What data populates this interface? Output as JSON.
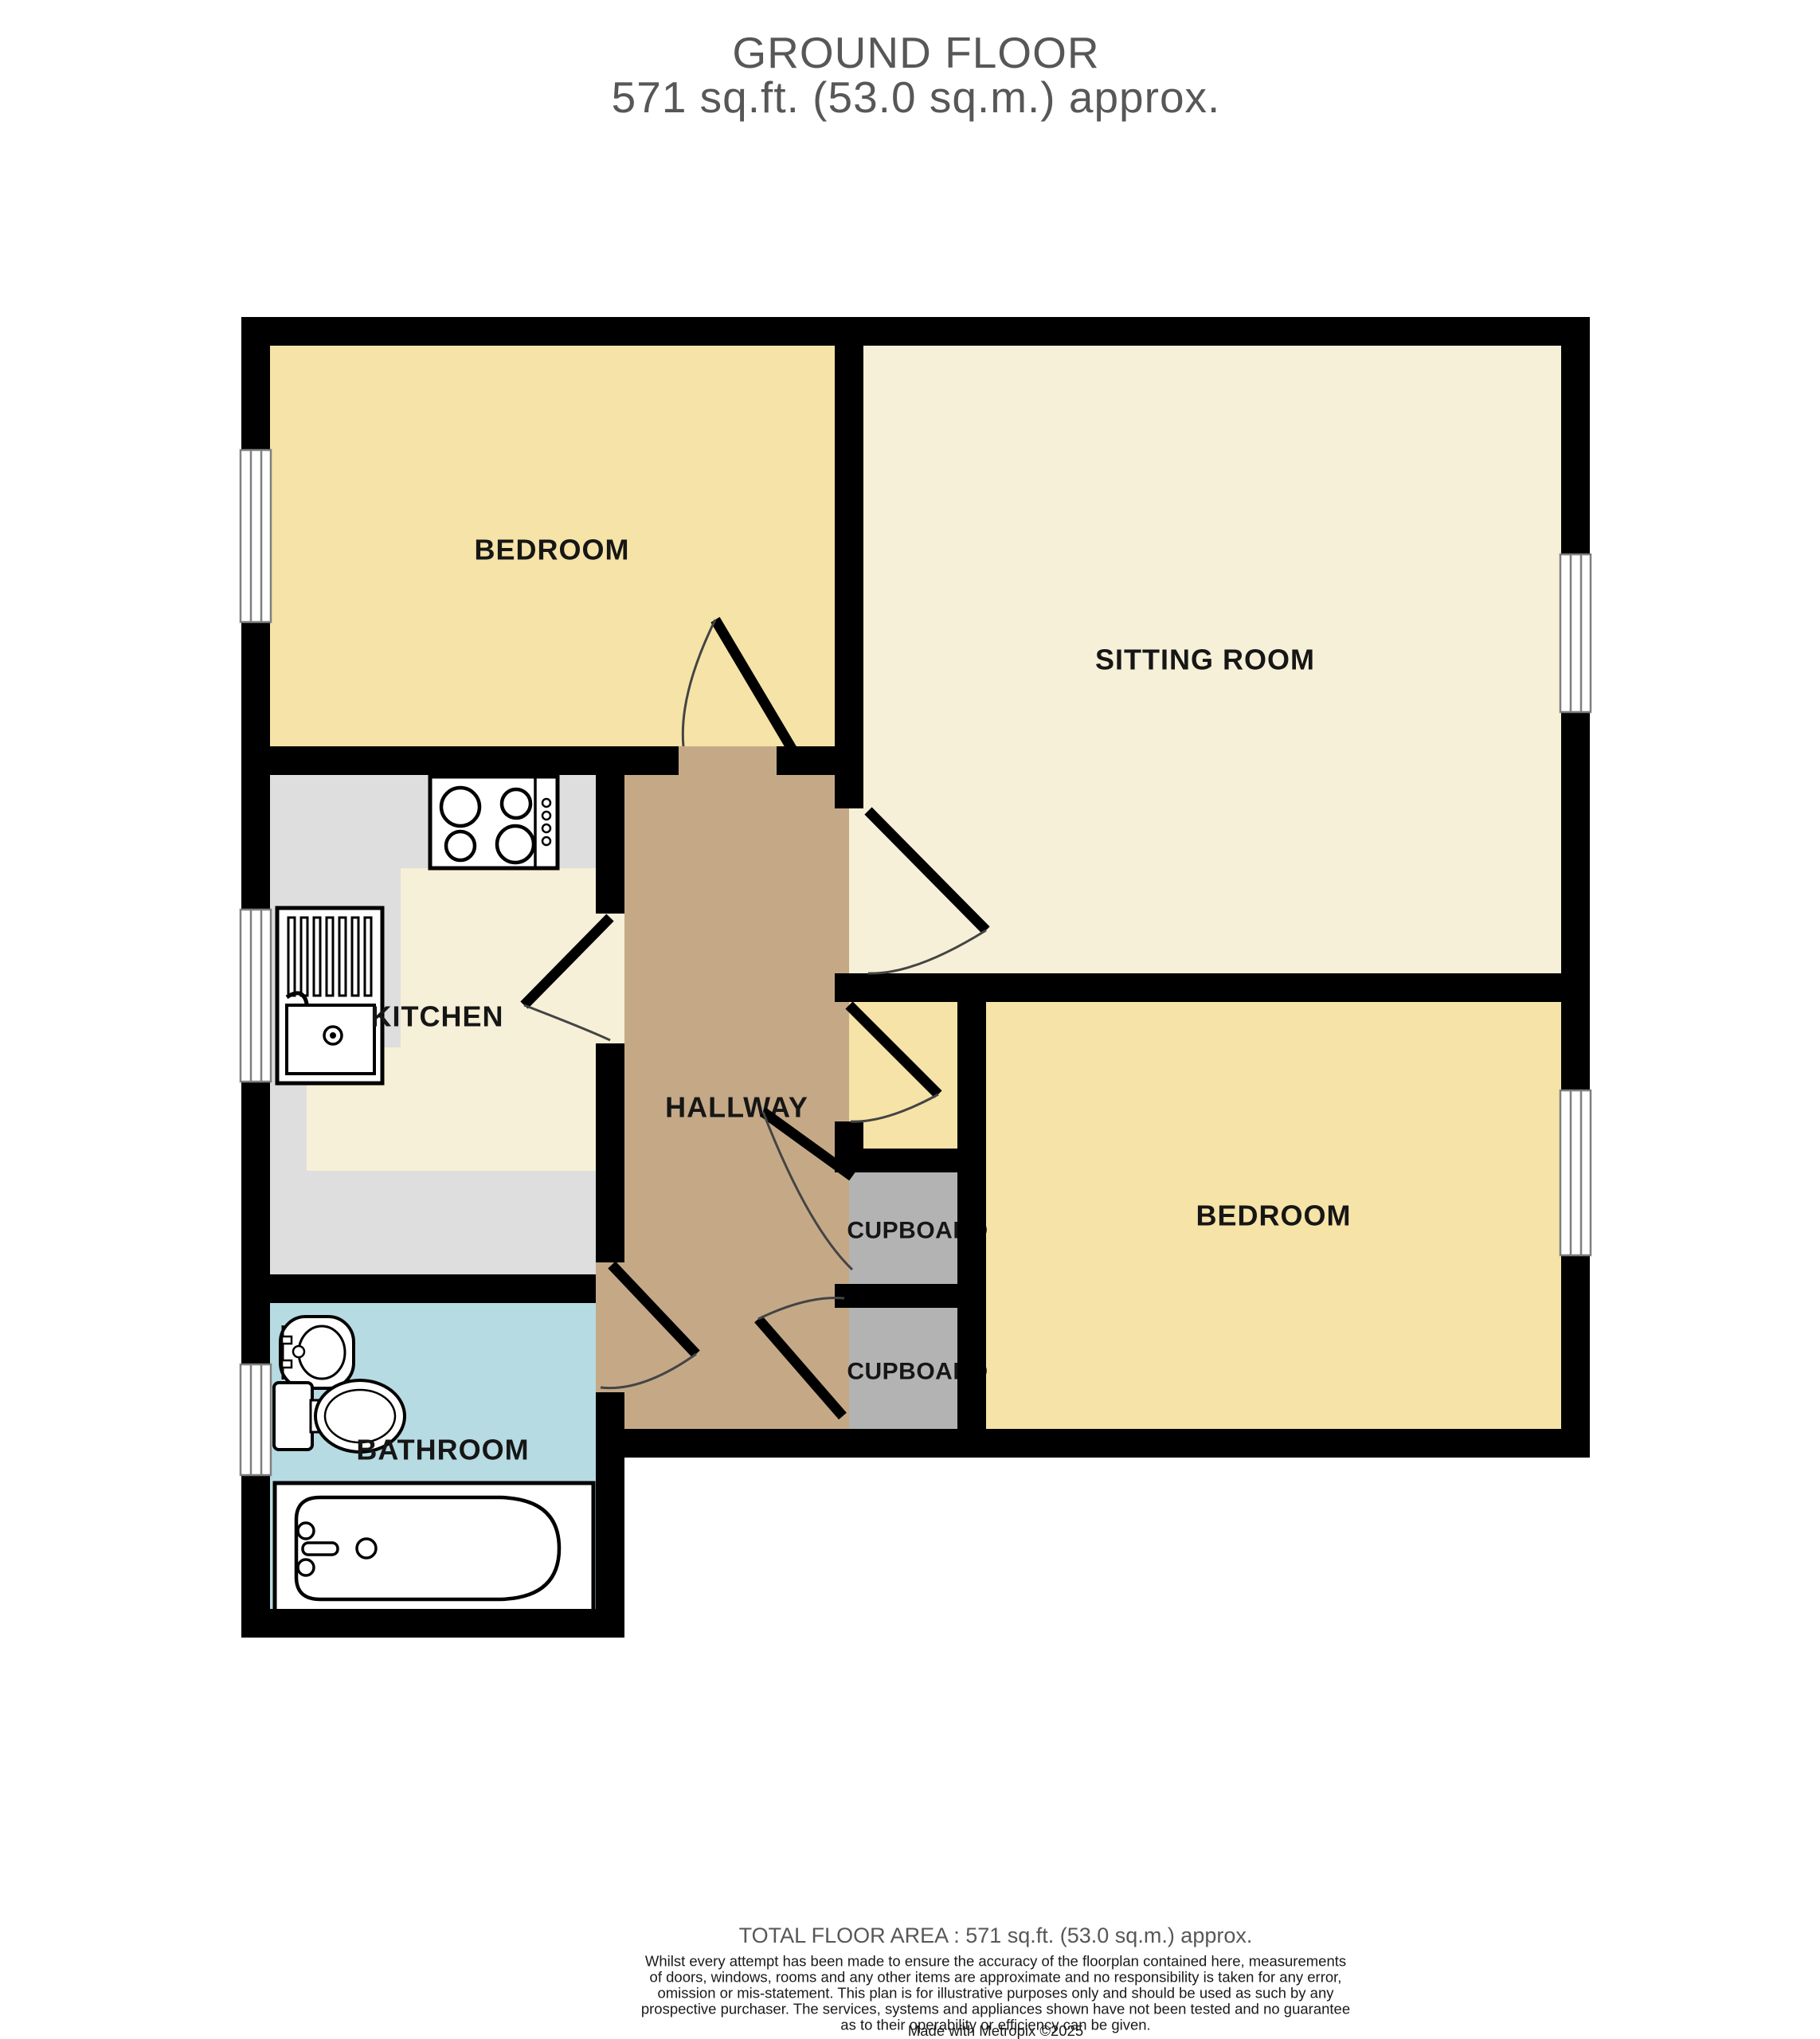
{
  "title": {
    "line1": "GROUND FLOOR",
    "line2": "571 sq.ft. (53.0 sq.m.) approx."
  },
  "rooms": {
    "bedroom1": {
      "label": "BEDROOM"
    },
    "sitting_room": {
      "label": "SITTING ROOM"
    },
    "kitchen": {
      "label": "KITCHEN"
    },
    "hallway": {
      "label": "HALLWAY"
    },
    "bedroom2": {
      "label": "BEDROOM"
    },
    "cupboard1": {
      "label": "CUPBOARD"
    },
    "cupboard2": {
      "label": "CUPBOARD"
    },
    "bathroom": {
      "label": "BATHROOM"
    }
  },
  "footer": {
    "total": "TOTAL FLOOR AREA : 571 sq.ft. (53.0 sq.m.) approx.",
    "disclaimer_lines": [
      "Whilst every attempt has been made to ensure the accuracy of the floorplan contained here, measurements",
      "of doors, windows, rooms and any other items are approximate and no responsibility is taken for any error,",
      "omission or mis-statement. This plan is for illustrative purposes only and should be used as such by any",
      "prospective purchaser. The services, systems and appliances shown have not been tested and no guarantee",
      "as to their operability or efficiency can be given.",
      "Made with Metropix ©2025"
    ]
  },
  "colors": {
    "wall": "#000000",
    "bedroom": "#F6E3A7",
    "sitting": "#F6F0D8",
    "kitchen_floor": "#F6F0D8",
    "counter": "#DEDEDE",
    "hallway": "#C5A987",
    "bathroom": "#B7DBE2",
    "cupboard": "#B3B3B3",
    "window_line": "#7F7F7F",
    "door_arc": "#444444",
    "label": "#161616",
    "muted": "#575757",
    "disclaimer": "#1a1a1a",
    "fixture_stroke": "#000000",
    "fixture_fill": "#FFFFFF"
  }
}
